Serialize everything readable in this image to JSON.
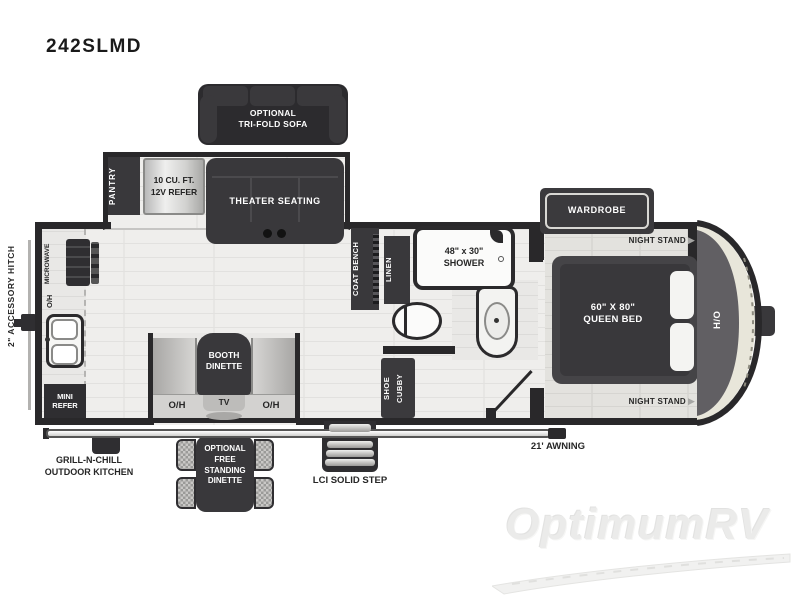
{
  "title": "242SLMD",
  "colors": {
    "wall": "#29282a",
    "furniture_dark": "#39383b",
    "floor": "#efeeec",
    "cap_cream": "#e8e6da",
    "cap_gray": "#615f63",
    "label_dark": "#262626",
    "label_light": "#ffffff",
    "watermark": "#ebebea"
  },
  "exterior": {
    "hitch": "2\" ACCESSORY HITCH",
    "awning": "21' AWNING",
    "grill": "GRILL-N-CHILL\nOUTDOOR KITCHEN",
    "steps": "LCI SOLID STEP",
    "free_standing_dinette": "OPTIONAL\nFREE\nSTANDING\nDINETTE"
  },
  "living": {
    "sofa": "OPTIONAL\nTRI-FOLD SOFA",
    "pantry": "PANTRY",
    "refer": "10 CU. FT.\n12V REFER",
    "theater": "THEATER SEATING",
    "booth": "BOOTH\nDINETTE",
    "tv": "TV",
    "oh_left": "O/H",
    "oh_right": "O/H"
  },
  "kitchen": {
    "microwave": "MICROWAVE",
    "oh": "O/H",
    "mini_refer": "MINI\nREFER"
  },
  "bath": {
    "coat_bench": "COAT BENCH",
    "linen": "LINEN",
    "shower": "48\" x 30\"\nSHOWER",
    "shoe_cubby": "SHOE\nCUBBY"
  },
  "bedroom": {
    "wardrobe": "WARDROBE",
    "night_stand_top": "NIGHT STAND",
    "night_stand_bottom": "NIGHT STAND",
    "bed": "60\" X 80\"\nQUEEN BED",
    "ho": "H/O",
    "arrow": "▶"
  },
  "watermark": "OptimumRV"
}
